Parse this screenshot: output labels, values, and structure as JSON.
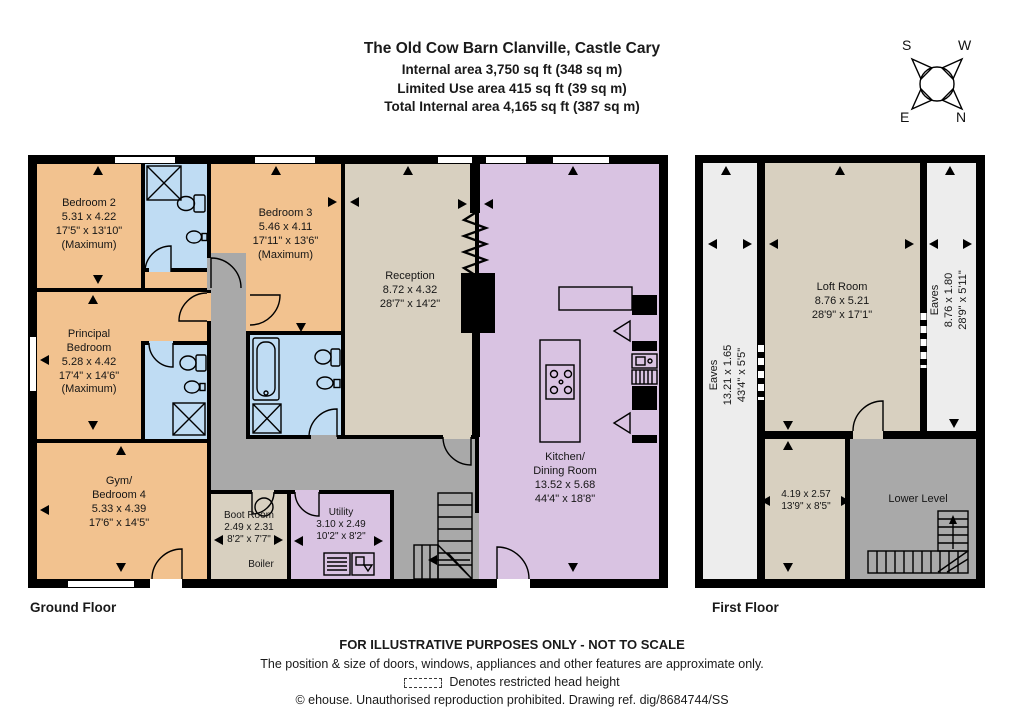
{
  "colors": {
    "page": "#ffffff",
    "wall": "#000000",
    "bedroom": "#f2c28f",
    "bath": "#bfdcf3",
    "beige": "#d8d0c0",
    "lilac": "#d9c3e2",
    "hall": "#a9a9a9",
    "eaves": "#ededed"
  },
  "header": {
    "title": "The Old Cow Barn Clanville, Castle Cary",
    "line1": "Internal area 3,750 sq ft (348 sq m)",
    "line2": "Limited Use area 415 sq ft (39 sq m)",
    "line3": "Total Internal area 4,165 sq ft (387 sq m)"
  },
  "compass": {
    "s": "S",
    "w": "W",
    "e": "E",
    "n": "N"
  },
  "ground_floor": {
    "label": "Ground Floor",
    "rooms": {
      "bedroom2": {
        "label": "Bedroom 2\n5.31 x 4.22\n17'5\" x 13'10\"\n(Maximum)"
      },
      "bedroom3": {
        "label": "Bedroom 3\n5.46 x 4.11\n17'11\" x 13'6\"\n(Maximum)"
      },
      "principal": {
        "label": "Principal\nBedroom\n5.28 x 4.42\n17'4\" x 14'6\"\n(Maximum)"
      },
      "gym": {
        "label": "Gym/\nBedroom 4\n5.33 x 4.39\n17'6\" x 14'5\""
      },
      "reception": {
        "label": "Reception\n8.72 x 4.32\n28'7\" x 14'2\""
      },
      "kitchen": {
        "label": "Kitchen/\nDining Room\n13.52 x 5.68\n44'4\" x 18'8\""
      },
      "boot_room": {
        "label": "Boot Room\n2.49 x 2.31\n8'2\" x 7'7\""
      },
      "boiler": {
        "label": "Boiler"
      },
      "utility": {
        "label": "Utility\n3.10 x 2.49\n10'2\" x 8'2\""
      }
    }
  },
  "first_floor": {
    "label": "First Floor",
    "rooms": {
      "loft": {
        "label": "Loft Room\n8.76 x 5.21\n28'9\" x 17'1\""
      },
      "eaves_left": {
        "label": "Eaves\n13.21 x 1.65\n43'4\" x 5'5\""
      },
      "eaves_right": {
        "label": "Eaves\n8.76 x 1.80\n28'9\" x 5'11\""
      },
      "room_419": {
        "label": "4.19 x 2.57\n13'9\" x 8'5\""
      },
      "lower_level": {
        "label": "Lower Level"
      }
    }
  },
  "footer": {
    "line1": "FOR ILLUSTRATIVE PURPOSES ONLY - NOT TO SCALE",
    "line2": "The position & size of doors, windows, appliances and other features are approximate only.",
    "line3": "Denotes restricted head height",
    "line4": "© ehouse. Unauthorised reproduction prohibited. Drawing ref. dig/8684744/SS"
  }
}
